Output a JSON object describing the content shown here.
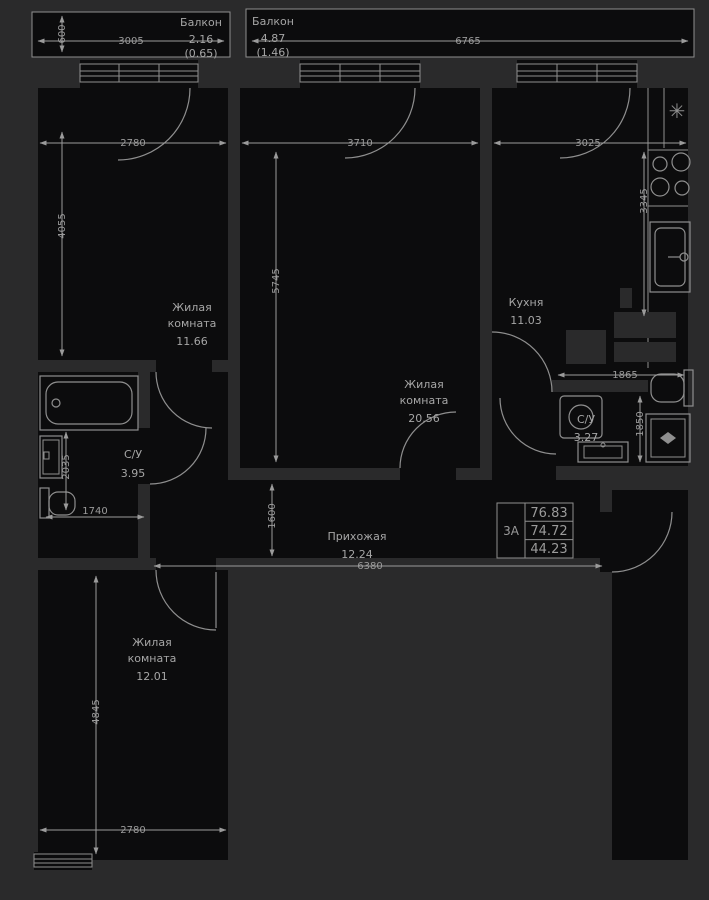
{
  "colors": {
    "background": "#2a2a2b",
    "room_fill": "#0c0c0d",
    "line": "#8f8f8f",
    "text": "#a6a6a6"
  },
  "balconies": [
    {
      "name": "Балкон",
      "area": "2.16",
      "reduced": "(0.65)"
    },
    {
      "name": "Балкон",
      "area": "4.87",
      "reduced": "(1.46)"
    }
  ],
  "rooms": [
    {
      "id": "living1",
      "l1": "Жилая",
      "l2": "комната",
      "area": "11.66"
    },
    {
      "id": "living2",
      "l1": "Жилая",
      "l2": "комната",
      "area": "20.56"
    },
    {
      "id": "kitchen",
      "l1": "Кухня",
      "area": "11.03"
    },
    {
      "id": "bath1",
      "l1": "С/У",
      "area": "3.95"
    },
    {
      "id": "bath2",
      "l1": "С/У",
      "area": "3.27"
    },
    {
      "id": "hall",
      "l1": "Прихожая",
      "area": "12.24"
    },
    {
      "id": "living3",
      "l1": "Жилая",
      "l2": "комната",
      "area": "12.01"
    }
  ],
  "dims": {
    "balcony1_width": "3005",
    "balcony1_depth": "600",
    "balcony2_width": "6765",
    "living1_width": "2780",
    "living1_height": "4055",
    "living2_width": "3710",
    "living2_height": "5745",
    "kitchen_width": "3025",
    "kitchen_height": "3345",
    "bath2_width": "1865",
    "bath2_height": "1850",
    "bath1_height": "2035",
    "bath1_width": "1740",
    "hall_height": "1600",
    "hall_width": "6380",
    "living3_height": "4845",
    "living3_width": "2780"
  },
  "info_box": {
    "unit_label": "3А",
    "rows": [
      "76.83",
      "74.72",
      "44.23"
    ]
  },
  "icons": {
    "snowflake": "✳"
  }
}
